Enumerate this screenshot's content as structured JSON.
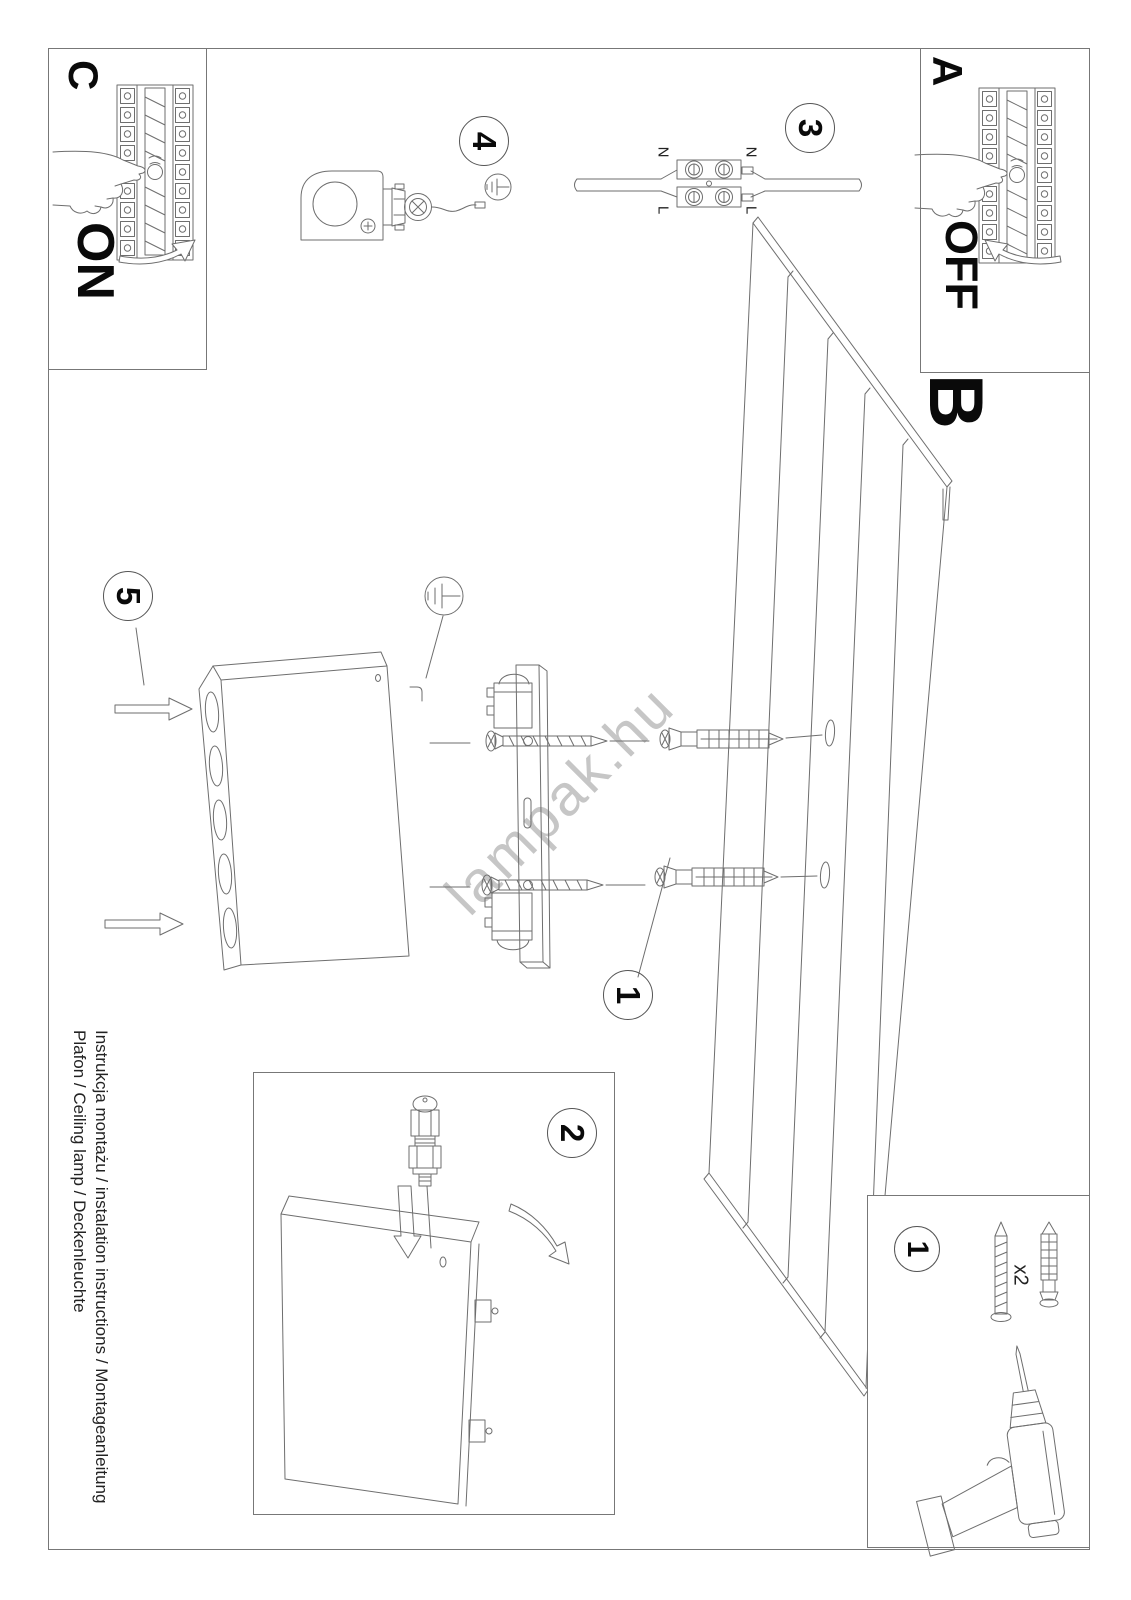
{
  "document": {
    "footer": {
      "line1": "Instrukcja montażu / instalation instructions / Montageanleitung",
      "line2": "Plafon / Ceiling lamp / Deckenleuchte"
    },
    "watermark": "lampak.hu"
  },
  "labels": {
    "power_off": {
      "letter": "A",
      "state": "OFF"
    },
    "ceiling": {
      "letter": "B"
    },
    "power_on": {
      "letter": "C",
      "state": "ON"
    },
    "wire_neutral": "N",
    "wire_live": "L",
    "parts_quantity": "x2"
  },
  "steps": {
    "drill": "1",
    "prepare": "2",
    "connect": "3",
    "gland": "4",
    "mount": "5"
  },
  "colors": {
    "line": "#6e6e6e",
    "text": "#111111",
    "watermark": "#c6c6c6"
  }
}
